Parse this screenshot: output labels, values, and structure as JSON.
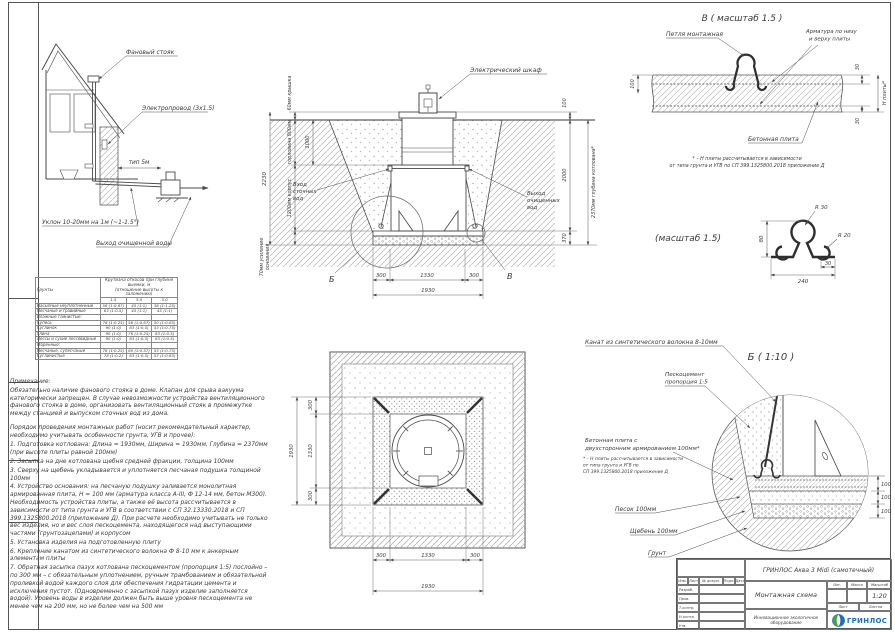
{
  "colors": {
    "line": "#4a4a4a",
    "brand_blue": "#1d6eb7",
    "brand_green": "#4aa23c"
  },
  "house": {
    "fan_riser": "Фановый стояк",
    "wire": "Электропровод (3х1.5)",
    "pipe_len": "тип 5м",
    "slope": "Уклон 10-20мм на 1м (~1-1.5°)",
    "outlet": "Выход очищенной воды"
  },
  "section": {
    "cabinet": "Электрический шкаф",
    "inlet": [
      "Вход",
      "сточных",
      "вод"
    ],
    "outlet": [
      "Выход",
      "очищенных",
      "вод"
    ],
    "dim_lid": "60мм крышка",
    "dim_neck": "горловина 900мм",
    "dim_total": "2230",
    "dim_body": "1200мм корпус",
    "dim_base1": "70мм усиление",
    "dim_base2": "основания",
    "dim_1000": "1000",
    "dim_100": "100",
    "dim_2000": "2000",
    "dim_370": "370",
    "dim_depth": "2370мм глубина котлована*",
    "dim_300a": "300",
    "dim_1330": "1330",
    "dim_300b": "300",
    "dim_1930": "1930",
    "mark_b": "Б",
    "mark_v": "В"
  },
  "detail_v": {
    "title": "В ( масштаб 1.5 )",
    "loop_label": "Петля монтажная",
    "rebar_label": [
      "Арматура по низу",
      "и верху плиты"
    ],
    "slab_label": "Бетонная плита",
    "dim_100": "100",
    "dim_30_top": "30",
    "dim_30_bot": "30",
    "dim_h": "Н плиты*",
    "note": [
      "* – Н плиты рассчитывается в зависимости",
      "от типа грунта и УГВ по СП 399.1325800.2018 приложение Д"
    ]
  },
  "detail_loop": {
    "title": "(масштаб 1.5)",
    "r30": "R 30",
    "r20": "R 20",
    "d80": "80",
    "d30": "30",
    "d240": "240"
  },
  "detail_b": {
    "title": "Б ( 1:10 )",
    "rope": "Канат из синтетического волокна 8-10мм",
    "sandcement": [
      "Пескоцемент",
      "пропорция 1:5"
    ],
    "slab": [
      "Бетонная плита с",
      "двухсторонним армированием 100мм*"
    ],
    "slab_note": [
      "* – Н плиты рассчитывается в зависимости",
      "от типа грунта и УГВ по",
      "СП 399.1325800.2018 приложение Д"
    ],
    "sand": "Песок 100мм",
    "gravel": "Щебень 100мм",
    "soil": "Грунт",
    "d1": "100",
    "d2": "100",
    "d3": "100"
  },
  "plan": {
    "dim_300a": "300",
    "dim_1330": "1330",
    "dim_300b": "300",
    "dim_1930": "1930",
    "vdim_300a": "300",
    "vdim_1330": "1330",
    "vdim_300b": "300",
    "vdim_1930": "1930"
  },
  "slope_table": {
    "col_soil": "Грунты",
    "col_main1": "Крутизна откосов при глубине выемки, м",
    "col_main2": "(отношение высоты к заложению)",
    "depths": [
      "1.5",
      "3.0",
      "5.0"
    ],
    "rows": [
      {
        "name": "Насыпные неуплотненные",
        "v": [
          "56 (1:0.67)",
          "45 (1:1)",
          "38 (1:1.25)"
        ]
      },
      {
        "name": "Песчаные и гравийные",
        "v": [
          "63 (1:0.5)",
          "45 (1:1)",
          "45 (1:1)"
        ]
      },
      {
        "name": "Влажные глинистые:",
        "v": [
          "",
          "",
          ""
        ]
      },
      {
        "name": "Супесь",
        "v": [
          "76 (1:0.25)",
          "56 (1:0.67)",
          "50 (1:0.85)"
        ]
      },
      {
        "name": "Суглинок",
        "v": [
          "90 (1:0)",
          "63 (1:0.5)",
          "53 (1:0.75)"
        ]
      },
      {
        "name": "Глина",
        "v": [
          "90 (1:0)",
          "76 (1:0.25)",
          "63 (1:0.5)"
        ]
      },
      {
        "name": "Лессы и сухие лессовидные",
        "v": [
          "90 (1:0)",
          "63 (1:0.5)",
          "63 (1:0.5)"
        ]
      },
      {
        "name": "Моренные:",
        "v": [
          "",
          "",
          ""
        ]
      },
      {
        "name": "Песчаные, супесчаные",
        "v": [
          "76 (1:0.25)",
          "60 (1:0.57)",
          "53 (1:0.75)"
        ]
      },
      {
        "name": "Суглинистые",
        "v": [
          "78 (1:0.2)",
          "63 (1:0.5)",
          "57 (1:0.65)"
        ]
      }
    ]
  },
  "notes": {
    "heading": "Примечание:",
    "para1": "Обязательно наличие фанового стояка в доме. Клапан для срыва вакуума категорически запрещен. В случае невозможности устройства вентиляционного фанового стояка в доме, организовать вентиляционный стояк в промежутке между станцией и выпуском сточных вод из дома.",
    "para2": "Порядок проведения монтажных работ (носит рекомендательный характер, необходимо учитывать особенности грунта, УГВ и прочее):",
    "items": [
      "1. Подготовка котлована: Длина = 1930мм,  Ширина = 1930мм,  Глубина = 2370мм (при высоте плиты равной 100мм)",
      "2. Засыпка на дне котлована щебня средней фракции, толщина 100мм",
      "3. Сверху на щебень укладывается и уплотняется песчаная подушка толщиной 100мм",
      "4. Устройство основания: на песчаную подушку заливается монолитная армированная плита, Н = 100 мм (арматура класса А-III, Ф 12-14 мм, бетон М300). Необходимость устройства плиты, а также её высота рассчитывается в зависимости от типа грунта и УГВ в соответствии с СП 32.13330.2018 и СП 399.1325800.2018 (приложение Д). При расчете необходимо учитывать не только вес изделия, но и вес слоя пескоцемента, находящегося над выступающими частями (грунтозацепами) и корпусом",
      "5. Установка изделия на подготовленную плиту",
      "6. Крепление канатом из синтетического волокна Ф 8-10 мм к анкерным элементам плиты",
      "7. Обратная засыпка пазух котлована пескоцементом (пропорция 1:5) послойно – по 300 мм – с обязательным уплотнением, ручным трамбованием и обязательной проливкой водой каждого слоя для обеспечения гидратации цемента и исключения пустот. (Одновременно с засыпкой пазух изделие заполняется водой). Уровень воды в изделии должен быть выше уровня пескоцемента не менее чем на 200 мм, но не более чем на 500 мм"
    ]
  },
  "titleblock": {
    "product": "ГРИНЛОС Аква 3 Midi (самотечный)",
    "doc": "Монтажная схема",
    "scale_label": "Масштаб",
    "scale": "1:20",
    "litera_label": "Лит.",
    "mass_label": "Масса",
    "sheet_label": "Лист",
    "sheets_label": "Листов",
    "slogan": "Инновационное экологичное оборудование",
    "brand": "ГРИНЛОС",
    "head_cols": [
      "Изм.",
      "Лист",
      "№ докум.",
      "Подп.",
      "Дата"
    ],
    "roles": [
      "Разраб.",
      "Пров.",
      "Т.контр.",
      "Н.контр.",
      "Утв."
    ]
  }
}
